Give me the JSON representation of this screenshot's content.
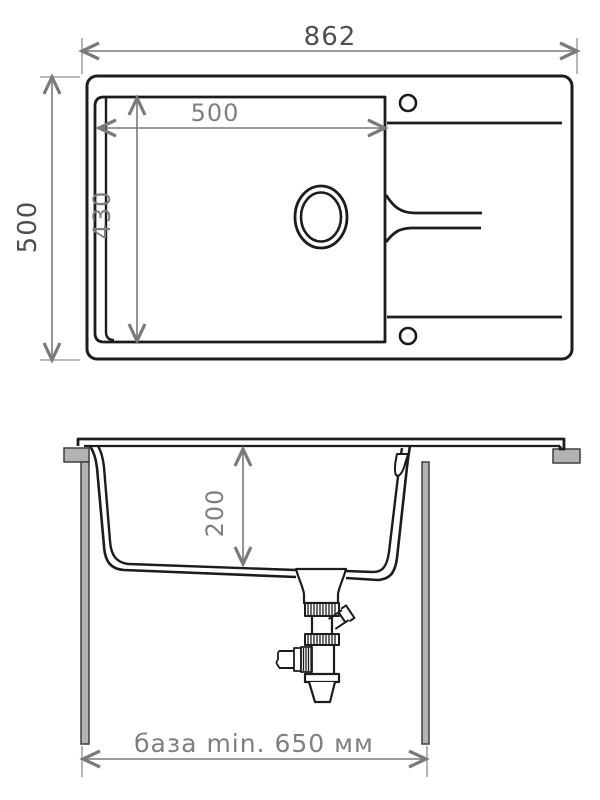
{
  "drawing": {
    "type": "sink-installation-technical-drawing",
    "colors": {
      "background": "#ffffff",
      "line": "#1c1c1c",
      "dimension_line": "#7a7a7a",
      "dimension_text_outer": "#4f4f4f",
      "dimension_text_inner": "#7f7f7f",
      "cabinet_gray": "#b3b3b3"
    },
    "top_view": {
      "overall_width_mm": "862",
      "overall_depth_mm": "500",
      "bowl_width_mm": "500",
      "bowl_depth_mm": "430"
    },
    "section_view": {
      "bowl_depth_mm": "200",
      "base_cabinet_note": "база min. 650 мм"
    }
  }
}
